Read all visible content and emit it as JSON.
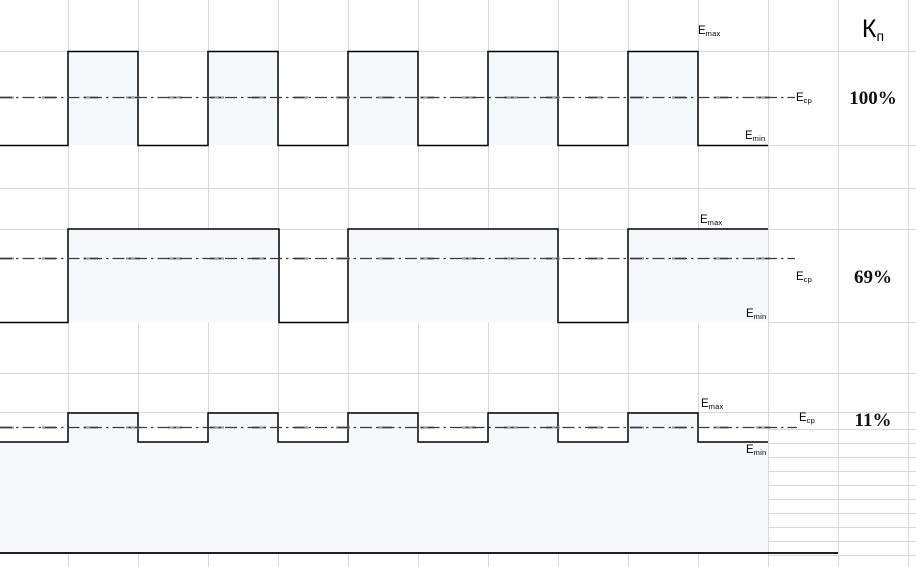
{
  "header": {
    "symbol": "К",
    "sub": "п"
  },
  "labels": {
    "e": "E",
    "max": "max",
    "min": "min",
    "avg": "ср"
  },
  "diagram": {
    "canvas": {
      "width": 916,
      "height": 567
    },
    "colors": {
      "background": "#ffffff",
      "grid": "#d8d8d8",
      "waveform_stroke": "#000000",
      "pulse_fill": "#f7f8fa",
      "dashdot_dark": "#3a3a3a",
      "dashdot_light": "#9a9a9a",
      "baseline": "#000000"
    },
    "grid": {
      "columns_x": [
        68,
        138,
        208,
        278,
        348,
        418,
        488,
        558,
        628,
        698,
        768,
        838,
        908
      ],
      "rows_y": [
        51,
        145,
        188,
        229,
        322,
        373,
        412
      ],
      "right_rows_y": [
        429,
        443,
        457,
        471,
        485,
        499,
        513,
        527,
        541,
        555
      ],
      "right_rows_x_start": 768
    },
    "charts": [
      {
        "id": "waveform-100",
        "kp": "100%",
        "area": [
          0,
          52,
          768,
          94
        ],
        "path": "M0,145.5 H68 V51.5 H138 V145.5 H208 V51.5 H278 V145.5 H348 V51.5 H418 V145.5 H488 V51.5 H558 V145.5 H628 V51.5 H698 V145.5 H768",
        "fills": [
          [
            68,
            51.5,
            70,
            94
          ],
          [
            208,
            51.5,
            70,
            94
          ],
          [
            348,
            51.5,
            70,
            94
          ],
          [
            488,
            51.5,
            70,
            94
          ],
          [
            628,
            51.5,
            70,
            94
          ]
        ],
        "ecp_y": 97.5,
        "dash_x_end": 795
      },
      {
        "id": "waveform-69",
        "kp": "69%",
        "area": [
          0,
          230,
          768,
          93
        ],
        "path": "M0,322.5 H68 V229 H279 V322.5 H348 V229 H558 V322.5 H628 V229 H768",
        "fills": [
          [
            68,
            229,
            211,
            93.5
          ],
          [
            348,
            229,
            210,
            93.5
          ],
          [
            628,
            229,
            140,
            93.5
          ]
        ],
        "ecp_y": 258.5,
        "dash_x_end": 795
      },
      {
        "id": "waveform-11",
        "kp": "11%",
        "area": [
          0,
          413,
          768,
          140
        ],
        "path": "M0,442 H68 V413 H138 V442 H208 V413 H278 V442 H348 V413 H418 V442 H488 V413 H558 V442 H628 V413 H698 V442 H768",
        "area_fill_close": "L768,553 L0,553 Z",
        "fills": [],
        "ecp_y": 427.5,
        "dash_x_end": 797
      }
    ],
    "baseline": {
      "x1": 0,
      "y": 553,
      "x2": 838
    }
  }
}
